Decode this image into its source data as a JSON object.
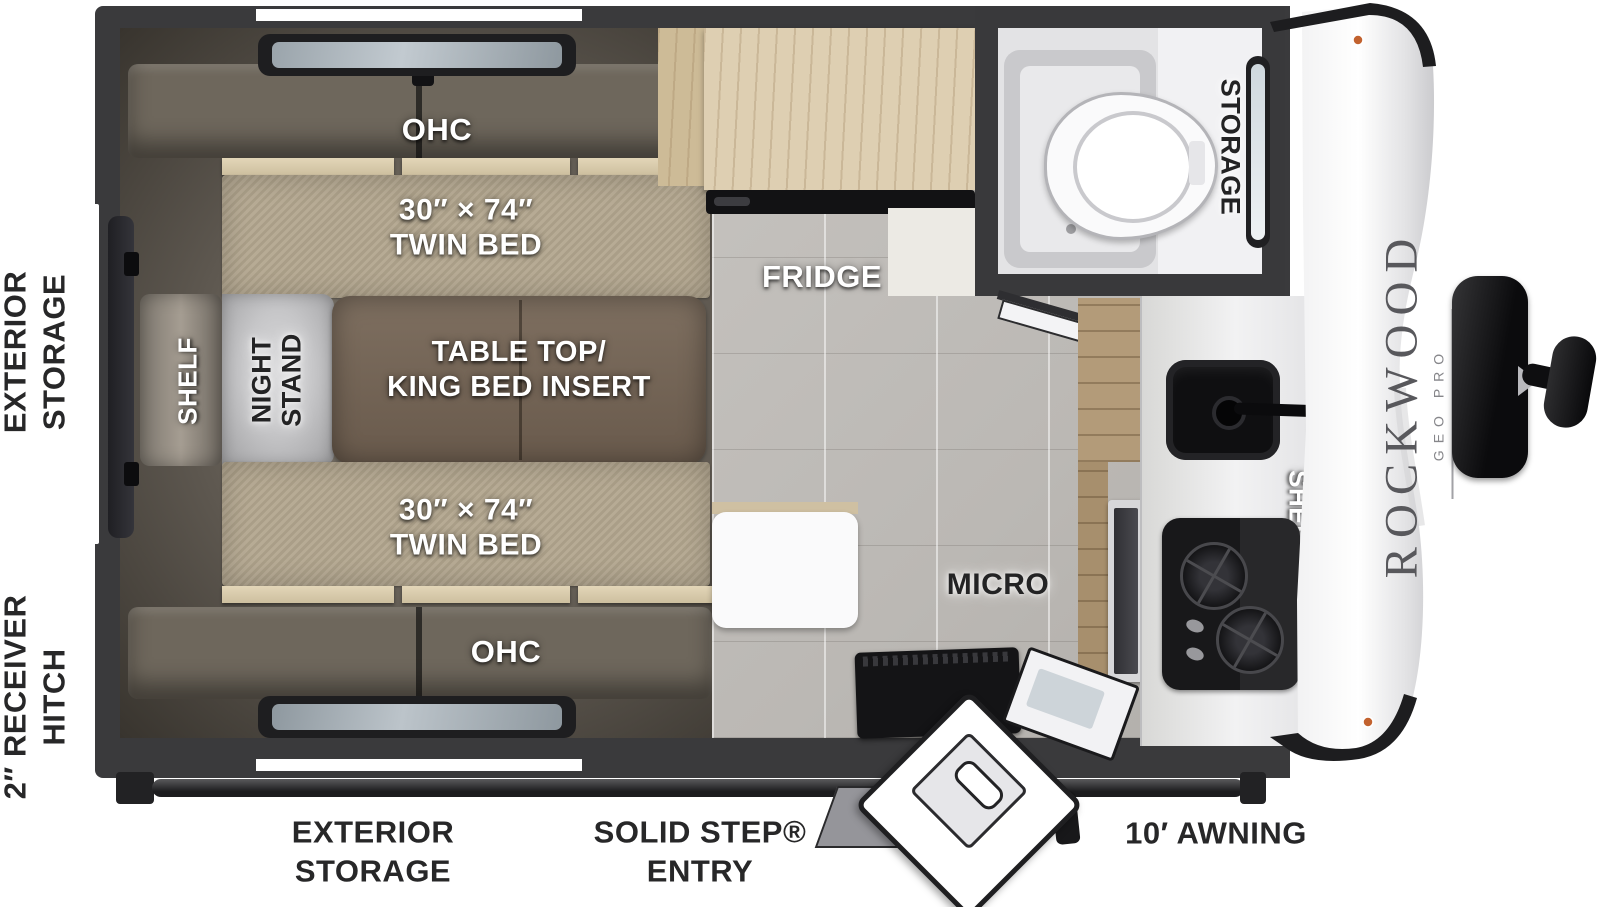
{
  "meta": {
    "title": "Rockwood Geo Pro travel trailer floor plan"
  },
  "brand": {
    "name": "ROCKWOOD",
    "series": "GEO PRO"
  },
  "colors": {
    "wall": "#3a3a3c",
    "floor_tile": "#c1beba",
    "mattress": "#b3a78f",
    "table": "#75665a",
    "cushion": "#6e675c",
    "fridge_wood": "#decfb2",
    "cabinet_wood": "#b39b79",
    "appliance_black": "#141416",
    "counter": "#ececee",
    "label_dark": "#272728"
  },
  "exterior": {
    "left_storage_line1": "EXTERIOR",
    "left_storage_line2": "STORAGE",
    "hitch_line1": "2″ RECEIVER",
    "hitch_line2": "HITCH",
    "bottom_storage_line1": "EXTERIOR",
    "bottom_storage_line2": "STORAGE",
    "entry_line1": "SOLID STEP®",
    "entry_line2": "ENTRY",
    "awning": "10′ AWNING"
  },
  "interior": {
    "ohc_top": "OHC",
    "ohc_bottom": "OHC",
    "bed_top_line1": "30″ × 74″",
    "bed_top_line2": "TWIN BED",
    "bed_bottom_line1": "30″ × 74″",
    "bed_bottom_line2": "TWIN BED",
    "shelf_left": "SHELF",
    "night_stand_line1": "NIGHT",
    "night_stand_line2": "STAND",
    "table_line1": "TABLE TOP/",
    "table_line2": "KING BED INSERT",
    "fridge": "FRIDGE",
    "bath_storage": "STORAGE",
    "micro": "MICRO",
    "shelf_right": "SHELF"
  }
}
